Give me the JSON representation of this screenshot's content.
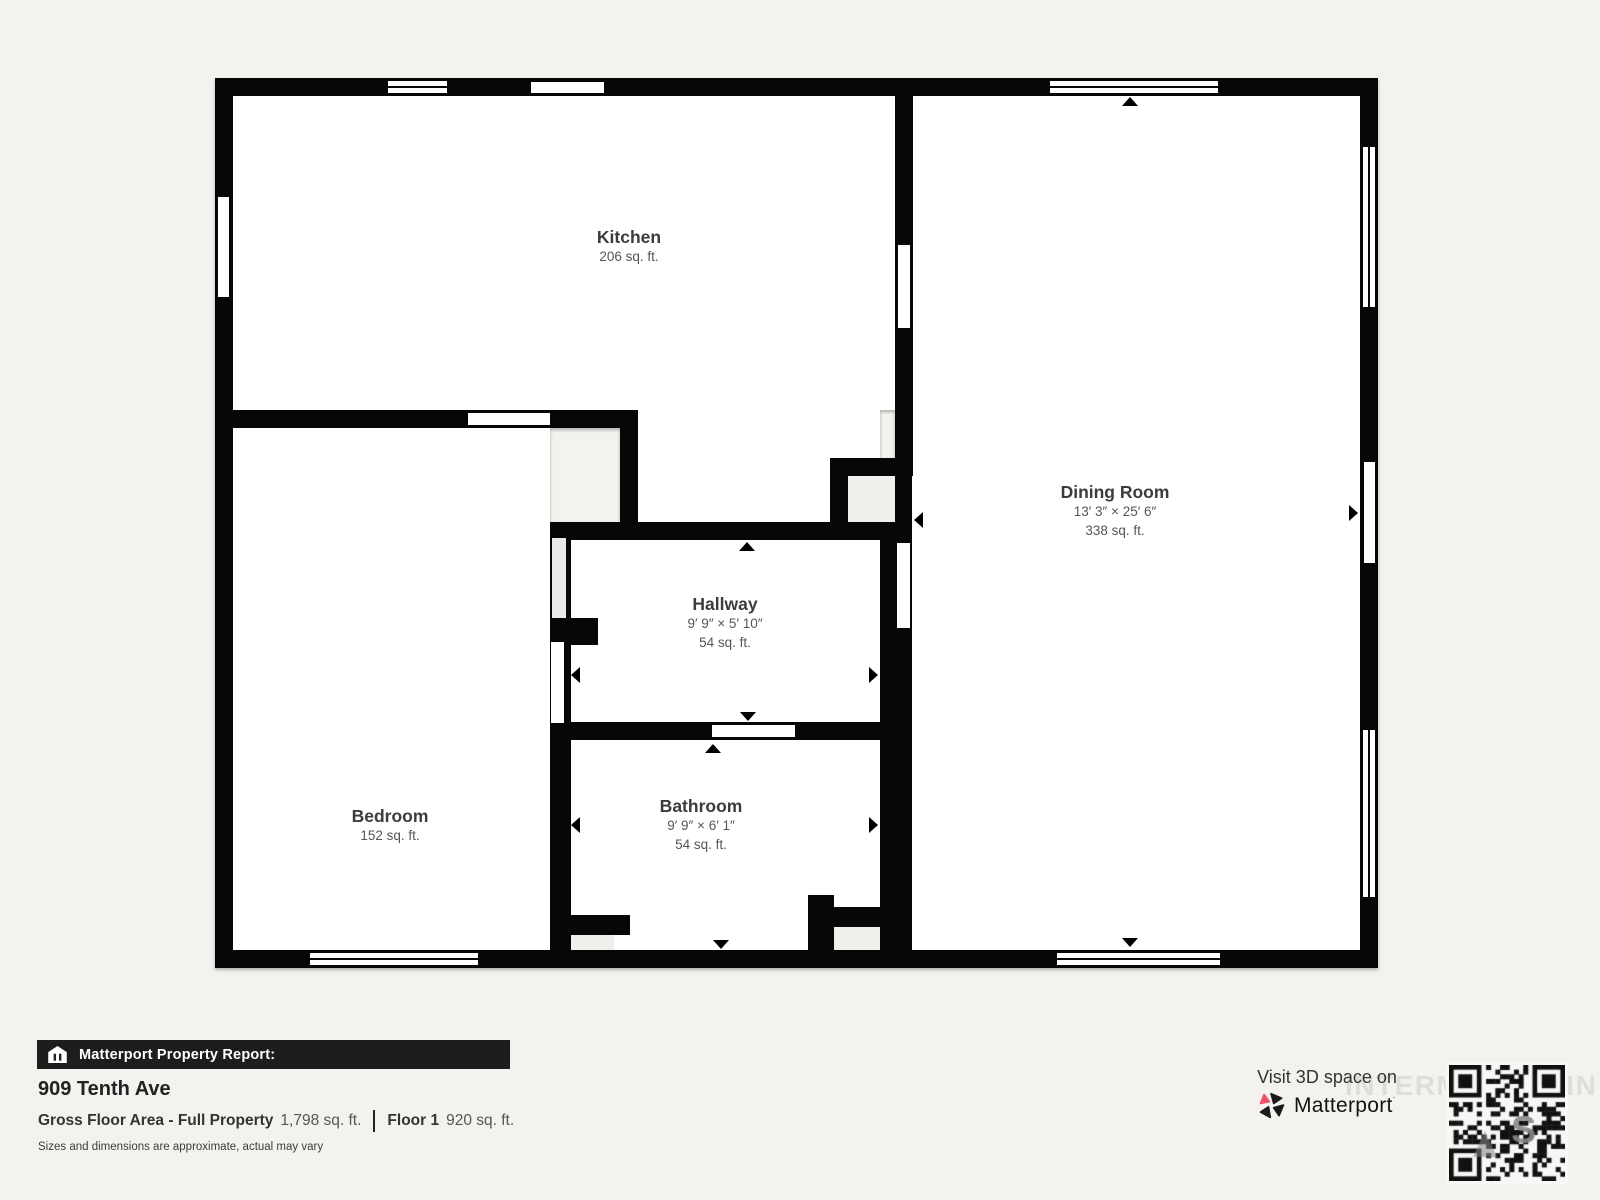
{
  "floorplan": {
    "wall_color": "#070707",
    "room_fill": "#ffffff",
    "closet_fill": "#f1efec",
    "rooms": {
      "kitchen": {
        "name": "Kitchen",
        "area": "206 sq. ft."
      },
      "dining": {
        "name": "Dining Room",
        "dims": "13′ 3″ × 25′ 6″",
        "area": "338 sq. ft."
      },
      "hallway": {
        "name": "Hallway",
        "dims": "9′ 9″ × 5′ 10″",
        "area": "54 sq. ft."
      },
      "bedroom": {
        "name": "Bedroom",
        "area": "152 sq. ft."
      },
      "bathroom": {
        "name": "Bathroom",
        "dims": "9′ 9″ × 6′ 1″",
        "area": "54 sq. ft."
      }
    }
  },
  "report": {
    "banner": "Matterport Property Report:",
    "address": "909 Tenth Ave",
    "gross_label": "Gross Floor Area - Full Property",
    "gross_value": "1,798 sq. ft.",
    "floor_label": "Floor 1",
    "floor_value": "920 sq. ft.",
    "disclaimer": "Sizes and dimensions are approximate, actual may vary"
  },
  "cta": {
    "visit_text": "Visit 3D space on",
    "brand": "Matterport",
    "brand_accent_color": "#f0506a",
    "watermark": "INTERMOUNTAIN"
  }
}
